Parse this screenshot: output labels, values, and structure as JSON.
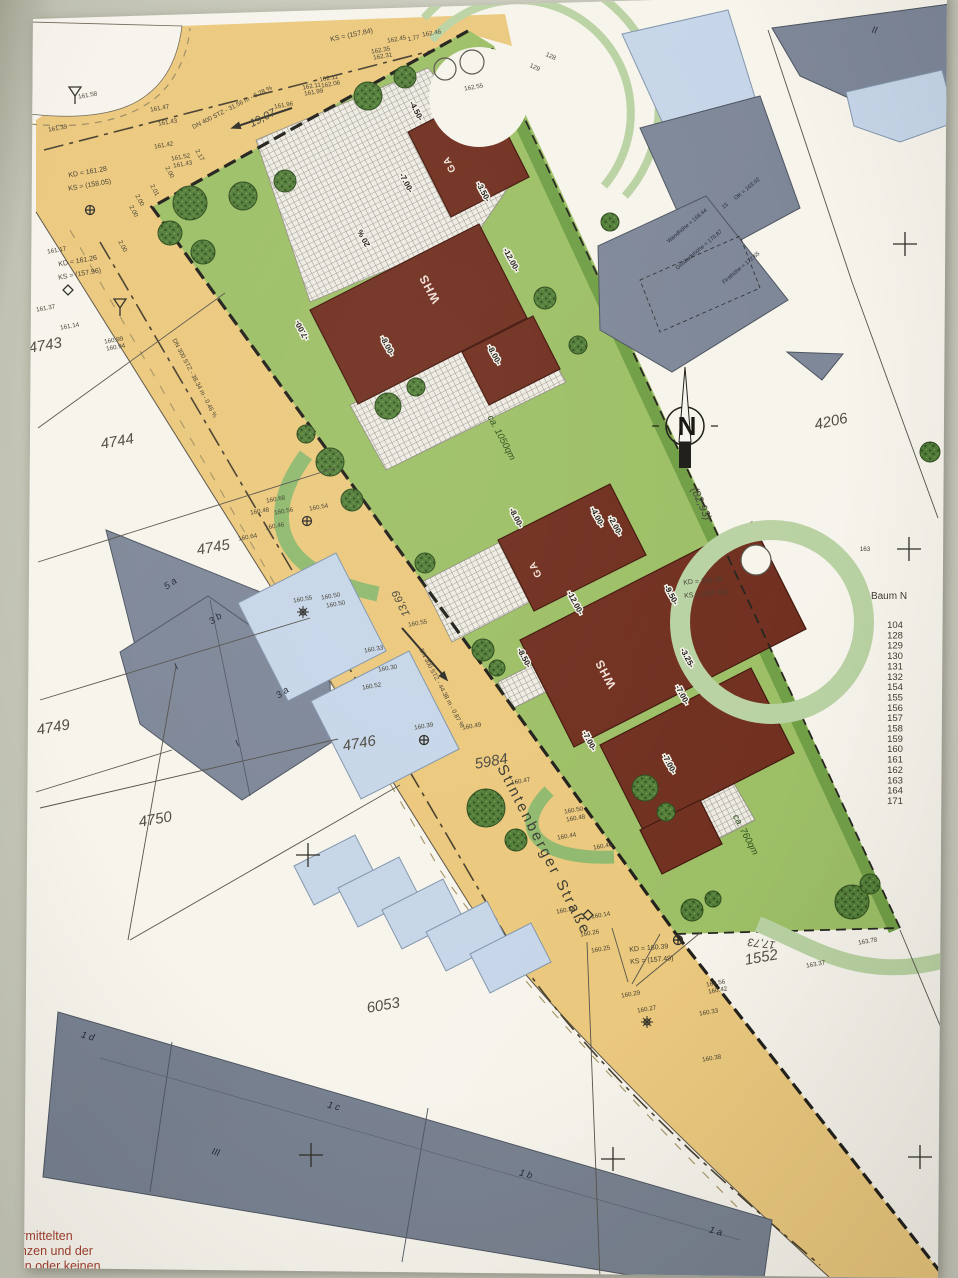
{
  "legend": {
    "title": "Baum N",
    "items": [
      "104",
      "128",
      "129",
      "130",
      "131",
      "132",
      "154",
      "155",
      "156",
      "157",
      "158",
      "159",
      "160",
      "161",
      "162",
      "163",
      "164",
      "171"
    ]
  },
  "footer": {
    "lines": [
      "bermittelten",
      "cksgrenzen und der",
      "ise keinen oder keinen"
    ]
  },
  "road": {
    "name": "Stintenberger Straße"
  },
  "compass": {
    "label": "N"
  },
  "colors": {
    "road": "#ebc87c",
    "lawn": "#9cbf64",
    "hedge": "#6f9e44",
    "building_red": "#6f2d1d",
    "neighbor_gray": "#7e8798",
    "annex_blue": "#c6d6e8",
    "paper": "#f7f4ec"
  },
  "labels": [
    {
      "c": "parcel",
      "t": "4743",
      "x": 46,
      "y": 350,
      "r": -10
    },
    {
      "c": "parcel",
      "t": "4744",
      "x": 118,
      "y": 446,
      "r": -10
    },
    {
      "c": "parcel",
      "t": "4745",
      "x": 214,
      "y": 552,
      "r": -10
    },
    {
      "c": "parcel",
      "t": "4749",
      "x": 54,
      "y": 732,
      "r": -10
    },
    {
      "c": "parcel",
      "t": "4750",
      "x": 156,
      "y": 824,
      "r": -10
    },
    {
      "c": "parcel",
      "t": "4746",
      "x": 360,
      "y": 748,
      "r": -10
    },
    {
      "c": "parcel",
      "t": "5984",
      "x": 492,
      "y": 766,
      "r": -10
    },
    {
      "c": "parcel",
      "t": "6053",
      "x": 384,
      "y": 1010,
      "r": -10
    },
    {
      "c": "parcel",
      "t": "4206",
      "x": 832,
      "y": 426,
      "r": -12
    },
    {
      "c": "parcel",
      "t": "1552",
      "x": 762,
      "y": 962,
      "r": -10
    },
    {
      "c": "meas",
      "t": "17,73",
      "x": 762,
      "y": 940,
      "r": 187
    },
    {
      "c": "meas",
      "t": "13,69",
      "x": 404,
      "y": 602,
      "r": 244
    },
    {
      "c": "meas",
      "t": "(82,93)",
      "x": 698,
      "y": 505,
      "r": 66
    },
    {
      "c": "meas",
      "t": "19,07",
      "x": 264,
      "y": 121,
      "r": -27
    },
    {
      "c": "tiny",
      "t": "161.58",
      "x": 88,
      "y": 97,
      "r": -10
    },
    {
      "c": "tiny",
      "t": "161.39",
      "x": 58,
      "y": 130,
      "r": -10
    },
    {
      "c": "tiny",
      "t": "161.47",
      "x": 160,
      "y": 110,
      "r": -10
    },
    {
      "c": "tiny",
      "t": "161.43",
      "x": 168,
      "y": 124,
      "r": -10
    },
    {
      "c": "tiny",
      "t": "161.42",
      "x": 164,
      "y": 147,
      "r": -10
    },
    {
      "c": "tiny",
      "t": "161.52",
      "x": 181,
      "y": 159,
      "r": -10
    },
    {
      "c": "tiny",
      "t": "161.43",
      "x": 183,
      "y": 166,
      "r": -10
    },
    {
      "c": "tiny",
      "t": "161.96",
      "x": 284,
      "y": 107,
      "r": -10
    },
    {
      "c": "tiny",
      "t": "162.11",
      "x": 312,
      "y": 88,
      "r": -10
    },
    {
      "c": "tiny",
      "t": "161.99",
      "x": 314,
      "y": 94,
      "r": -10
    },
    {
      "c": "tiny",
      "t": "162.11",
      "x": 329,
      "y": 80,
      "r": -10
    },
    {
      "c": "tiny",
      "t": "162.06",
      "x": 331,
      "y": 86,
      "r": -10
    },
    {
      "c": "tiny",
      "t": "162.45",
      "x": 397,
      "y": 41,
      "r": -10
    },
    {
      "c": "tiny",
      "t": "1.77",
      "x": 414,
      "y": 40,
      "r": -12
    },
    {
      "c": "tiny",
      "t": "162.46",
      "x": 432,
      "y": 35,
      "r": -10
    },
    {
      "c": "tiny",
      "t": "162.35",
      "x": 381,
      "y": 52,
      "r": -10
    },
    {
      "c": "tiny",
      "t": "162.31",
      "x": 383,
      "y": 58,
      "r": -10
    },
    {
      "c": "kd",
      "t": "KS = (157.84)",
      "x": 352,
      "y": 37,
      "r": -12
    },
    {
      "c": "tiny",
      "t": "162.55",
      "x": 474,
      "y": 89,
      "r": -10
    },
    {
      "c": "tiny",
      "t": "128",
      "x": 550,
      "y": 58,
      "r": 25
    },
    {
      "c": "tiny",
      "t": "129",
      "x": 534,
      "y": 69,
      "r": 25
    },
    {
      "c": "tiny",
      "t": "163",
      "x": 865,
      "y": 551,
      "r": 0
    },
    {
      "c": "tiny",
      "t": "2.17",
      "x": 198,
      "y": 156,
      "r": 62
    },
    {
      "c": "tiny",
      "t": "2.00",
      "x": 168,
      "y": 173,
      "r": 62
    },
    {
      "c": "tiny",
      "t": "2.01",
      "x": 153,
      "y": 191,
      "r": 62
    },
    {
      "c": "tiny",
      "t": "2.00",
      "x": 138,
      "y": 201,
      "r": 62
    },
    {
      "c": "tiny",
      "t": "2.00",
      "x": 132,
      "y": 212,
      "r": 62
    },
    {
      "c": "tiny",
      "t": "2.00",
      "x": 121,
      "y": 247,
      "r": 62
    },
    {
      "c": "tiny",
      "t": "161.17",
      "x": 57,
      "y": 252,
      "r": -10
    },
    {
      "c": "tiny",
      "t": "161.37",
      "x": 46,
      "y": 310,
      "r": -10
    },
    {
      "c": "tiny",
      "t": "161.14",
      "x": 70,
      "y": 328,
      "r": -10
    },
    {
      "c": "tiny",
      "t": "160.99",
      "x": 114,
      "y": 342,
      "r": -10
    },
    {
      "c": "tiny",
      "t": "160.94",
      "x": 116,
      "y": 349,
      "r": -10
    },
    {
      "c": "tiny",
      "t": "160.68",
      "x": 276,
      "y": 501,
      "r": -10
    },
    {
      "c": "tiny",
      "t": "160.48",
      "x": 260,
      "y": 513,
      "r": -10
    },
    {
      "c": "tiny",
      "t": "160.56",
      "x": 284,
      "y": 513,
      "r": -10
    },
    {
      "c": "tiny",
      "t": "160.46",
      "x": 275,
      "y": 528,
      "r": -10
    },
    {
      "c": "tiny",
      "t": "160.64",
      "x": 248,
      "y": 539,
      "r": -10
    },
    {
      "c": "tiny",
      "t": "160.54",
      "x": 319,
      "y": 509,
      "r": -10
    },
    {
      "c": "tiny",
      "t": "160.55",
      "x": 303,
      "y": 601,
      "r": -10
    },
    {
      "c": "tiny",
      "t": "160.50",
      "x": 331,
      "y": 598,
      "r": -10
    },
    {
      "c": "tiny",
      "t": "160.50",
      "x": 336,
      "y": 606,
      "r": -10
    },
    {
      "c": "tiny",
      "t": "160.55",
      "x": 418,
      "y": 625,
      "r": -10
    },
    {
      "c": "tiny",
      "t": "160.33",
      "x": 374,
      "y": 651,
      "r": -10
    },
    {
      "c": "tiny",
      "t": "160.30",
      "x": 388,
      "y": 670,
      "r": -10
    },
    {
      "c": "tiny",
      "t": "160.52",
      "x": 372,
      "y": 688,
      "r": -10
    },
    {
      "c": "tiny",
      "t": "160.39",
      "x": 424,
      "y": 728,
      "r": -10
    },
    {
      "c": "tiny",
      "t": "160.49",
      "x": 472,
      "y": 728,
      "r": -10
    },
    {
      "c": "tiny",
      "t": "160.47",
      "x": 521,
      "y": 783,
      "r": -10
    },
    {
      "c": "tiny",
      "t": "160.50",
      "x": 574,
      "y": 812,
      "r": -10
    },
    {
      "c": "tiny",
      "t": "160.48",
      "x": 576,
      "y": 820,
      "r": -10
    },
    {
      "c": "tiny",
      "t": "160.44",
      "x": 567,
      "y": 838,
      "r": -10
    },
    {
      "c": "tiny",
      "t": "160.46",
      "x": 603,
      "y": 848,
      "r": -10
    },
    {
      "c": "tiny",
      "t": "160.38",
      "x": 566,
      "y": 912,
      "r": -10
    },
    {
      "c": "tiny",
      "t": "160.14",
      "x": 601,
      "y": 917,
      "r": -10
    },
    {
      "c": "tiny",
      "t": "160.26",
      "x": 590,
      "y": 935,
      "r": -10
    },
    {
      "c": "tiny",
      "t": "160.25",
      "x": 601,
      "y": 951,
      "r": -10
    },
    {
      "c": "tiny",
      "t": "160.56",
      "x": 716,
      "y": 985,
      "r": -10
    },
    {
      "c": "tiny",
      "t": "160.42",
      "x": 718,
      "y": 992,
      "r": -10
    },
    {
      "c": "tiny",
      "t": "160.29",
      "x": 631,
      "y": 996,
      "r": -10
    },
    {
      "c": "tiny",
      "t": "160.27",
      "x": 647,
      "y": 1011,
      "r": -10
    },
    {
      "c": "tiny",
      "t": "160.33",
      "x": 709,
      "y": 1014,
      "r": -10
    },
    {
      "c": "tiny",
      "t": "160.38",
      "x": 712,
      "y": 1060,
      "r": -10
    },
    {
      "c": "tiny",
      "t": "163.37",
      "x": 816,
      "y": 966,
      "r": -10
    },
    {
      "c": "tiny",
      "t": "163.78",
      "x": 868,
      "y": 943,
      "r": -10
    },
    {
      "c": "tiny",
      "t": "DN 400 STZ - 31.56 m - 5.28 %",
      "x": 233,
      "y": 109,
      "r": -27
    },
    {
      "c": "tiny",
      "t": "DN 300 STZ - 38.34 m - 0.46 %",
      "x": 193,
      "y": 379,
      "r": 62
    },
    {
      "c": "tiny",
      "t": "DN 300 STZ - 44.38 m - 0.87 %",
      "x": 440,
      "y": 689,
      "r": 62
    },
    {
      "c": "kd",
      "t": "KD = 161.28",
      "x": 88,
      "y": 174,
      "r": -10
    },
    {
      "c": "kd",
      "t": "KS = (158.05)",
      "x": 90,
      "y": 187,
      "r": -10
    },
    {
      "c": "kd",
      "t": "KD = 161.26",
      "x": 78,
      "y": 263,
      "r": -10
    },
    {
      "c": "kd",
      "t": "KS = (157.96)",
      "x": 80,
      "y": 276,
      "r": -10
    },
    {
      "c": "kd",
      "t": "KD = 160.39",
      "x": 703,
      "y": 583,
      "r": -5
    },
    {
      "c": "kd",
      "t": "KS = (157.49)",
      "x": 706,
      "y": 596,
      "r": -5
    },
    {
      "c": "kd",
      "t": "KD = 160.39",
      "x": 649,
      "y": 950,
      "r": -5
    },
    {
      "c": "kd",
      "t": "KS = (157.49)",
      "x": 652,
      "y": 962,
      "r": -5
    },
    {
      "c": "dim",
      "t": "-7.00-",
      "x": 404,
      "y": 184,
      "r": 62
    },
    {
      "c": "dim",
      "t": "-4.50-",
      "x": 414,
      "y": 112,
      "r": 62
    },
    {
      "c": "dim",
      "t": "-3.50-",
      "x": 481,
      "y": 193,
      "r": 62
    },
    {
      "c": "dim",
      "t": "-12.00-",
      "x": 509,
      "y": 261,
      "r": 62
    },
    {
      "c": "dim",
      "t": "-8.00-",
      "x": 385,
      "y": 347,
      "r": 62
    },
    {
      "c": "dim",
      "t": "-8.00-",
      "x": 492,
      "y": 356,
      "r": 62
    },
    {
      "c": "dim",
      "t": "-7.00-",
      "x": 304,
      "y": 329,
      "r": 242
    },
    {
      "c": "dim",
      "t": "20 %",
      "x": 366,
      "y": 237,
      "r": 242
    },
    {
      "c": "dim",
      "t": "-8.00-",
      "x": 514,
      "y": 519,
      "r": 62
    },
    {
      "c": "dim",
      "t": "-4.00-",
      "x": 595,
      "y": 518,
      "r": 62
    },
    {
      "c": "dim",
      "t": "-2.00-",
      "x": 613,
      "y": 527,
      "r": 62
    },
    {
      "c": "dim",
      "t": "-12.00-",
      "x": 573,
      "y": 604,
      "r": 62
    },
    {
      "c": "dim",
      "t": "-9.50-",
      "x": 669,
      "y": 596,
      "r": 62
    },
    {
      "c": "dim",
      "t": "-8.50-",
      "x": 522,
      "y": 659,
      "r": 62
    },
    {
      "c": "dim",
      "t": "-3.25-",
      "x": 685,
      "y": 659,
      "r": 62
    },
    {
      "c": "dim",
      "t": "-7.00-",
      "x": 680,
      "y": 696,
      "r": 62
    },
    {
      "c": "dim",
      "t": "-7.00-",
      "x": 587,
      "y": 742,
      "r": 62
    },
    {
      "c": "dim",
      "t": "-7.00-",
      "x": 667,
      "y": 765,
      "r": 62
    },
    {
      "c": "name",
      "t": "WHS",
      "x": 433,
      "y": 287,
      "r": 242
    },
    {
      "c": "name",
      "t": "GA",
      "x": 452,
      "y": 163,
      "r": 242,
      "s": 10
    },
    {
      "c": "name",
      "t": "WHS",
      "x": 609,
      "y": 672,
      "r": 242
    },
    {
      "c": "name",
      "t": "GA",
      "x": 538,
      "y": 568,
      "r": 242,
      "s": 10
    },
    {
      "c": "area",
      "t": "ca. 1050qm",
      "x": 499,
      "y": 439,
      "r": 62
    },
    {
      "c": "area",
      "t": "ca. 760qm",
      "x": 743,
      "y": 836,
      "r": 62
    },
    {
      "c": "bld",
      "t": "5 a",
      "x": 172,
      "y": 586,
      "r": -35
    },
    {
      "c": "bld",
      "t": "3 b",
      "x": 217,
      "y": 621,
      "r": -35
    },
    {
      "c": "bld",
      "t": "3 a",
      "x": 284,
      "y": 695,
      "r": -35
    },
    {
      "c": "bld",
      "t": "I",
      "x": 178,
      "y": 669,
      "r": -35
    },
    {
      "c": "bld",
      "t": "I",
      "x": 239,
      "y": 746,
      "r": -35
    },
    {
      "c": "bld",
      "t": "1 d",
      "x": 87,
      "y": 1039,
      "r": 16
    },
    {
      "c": "bld",
      "t": "1 c",
      "x": 333,
      "y": 1109,
      "r": 16
    },
    {
      "c": "bld",
      "t": "1 b",
      "x": 525,
      "y": 1177,
      "r": 16
    },
    {
      "c": "bld",
      "t": "1 a",
      "x": 715,
      "y": 1234,
      "r": 16
    },
    {
      "c": "bld",
      "t": "III",
      "x": 215,
      "y": 1155,
      "r": 16
    },
    {
      "c": "bld",
      "t": "II",
      "x": 874,
      "y": 33,
      "r": 12
    },
    {
      "c": "micro",
      "t": "OK = 163.02",
      "x": 748,
      "y": 190,
      "r": -40
    },
    {
      "c": "micro",
      "t": "15",
      "x": 726,
      "y": 207,
      "r": -40
    },
    {
      "c": "micro",
      "t": "Wandhöhe = 168.44",
      "x": 688,
      "y": 227,
      "r": -40
    },
    {
      "c": "micro",
      "t": "Gebäudehöhe = 170.87",
      "x": 700,
      "y": 251,
      "r": -40
    },
    {
      "c": "micro",
      "t": "Firsthöhe = 172.65",
      "x": 742,
      "y": 269,
      "r": -40
    }
  ]
}
